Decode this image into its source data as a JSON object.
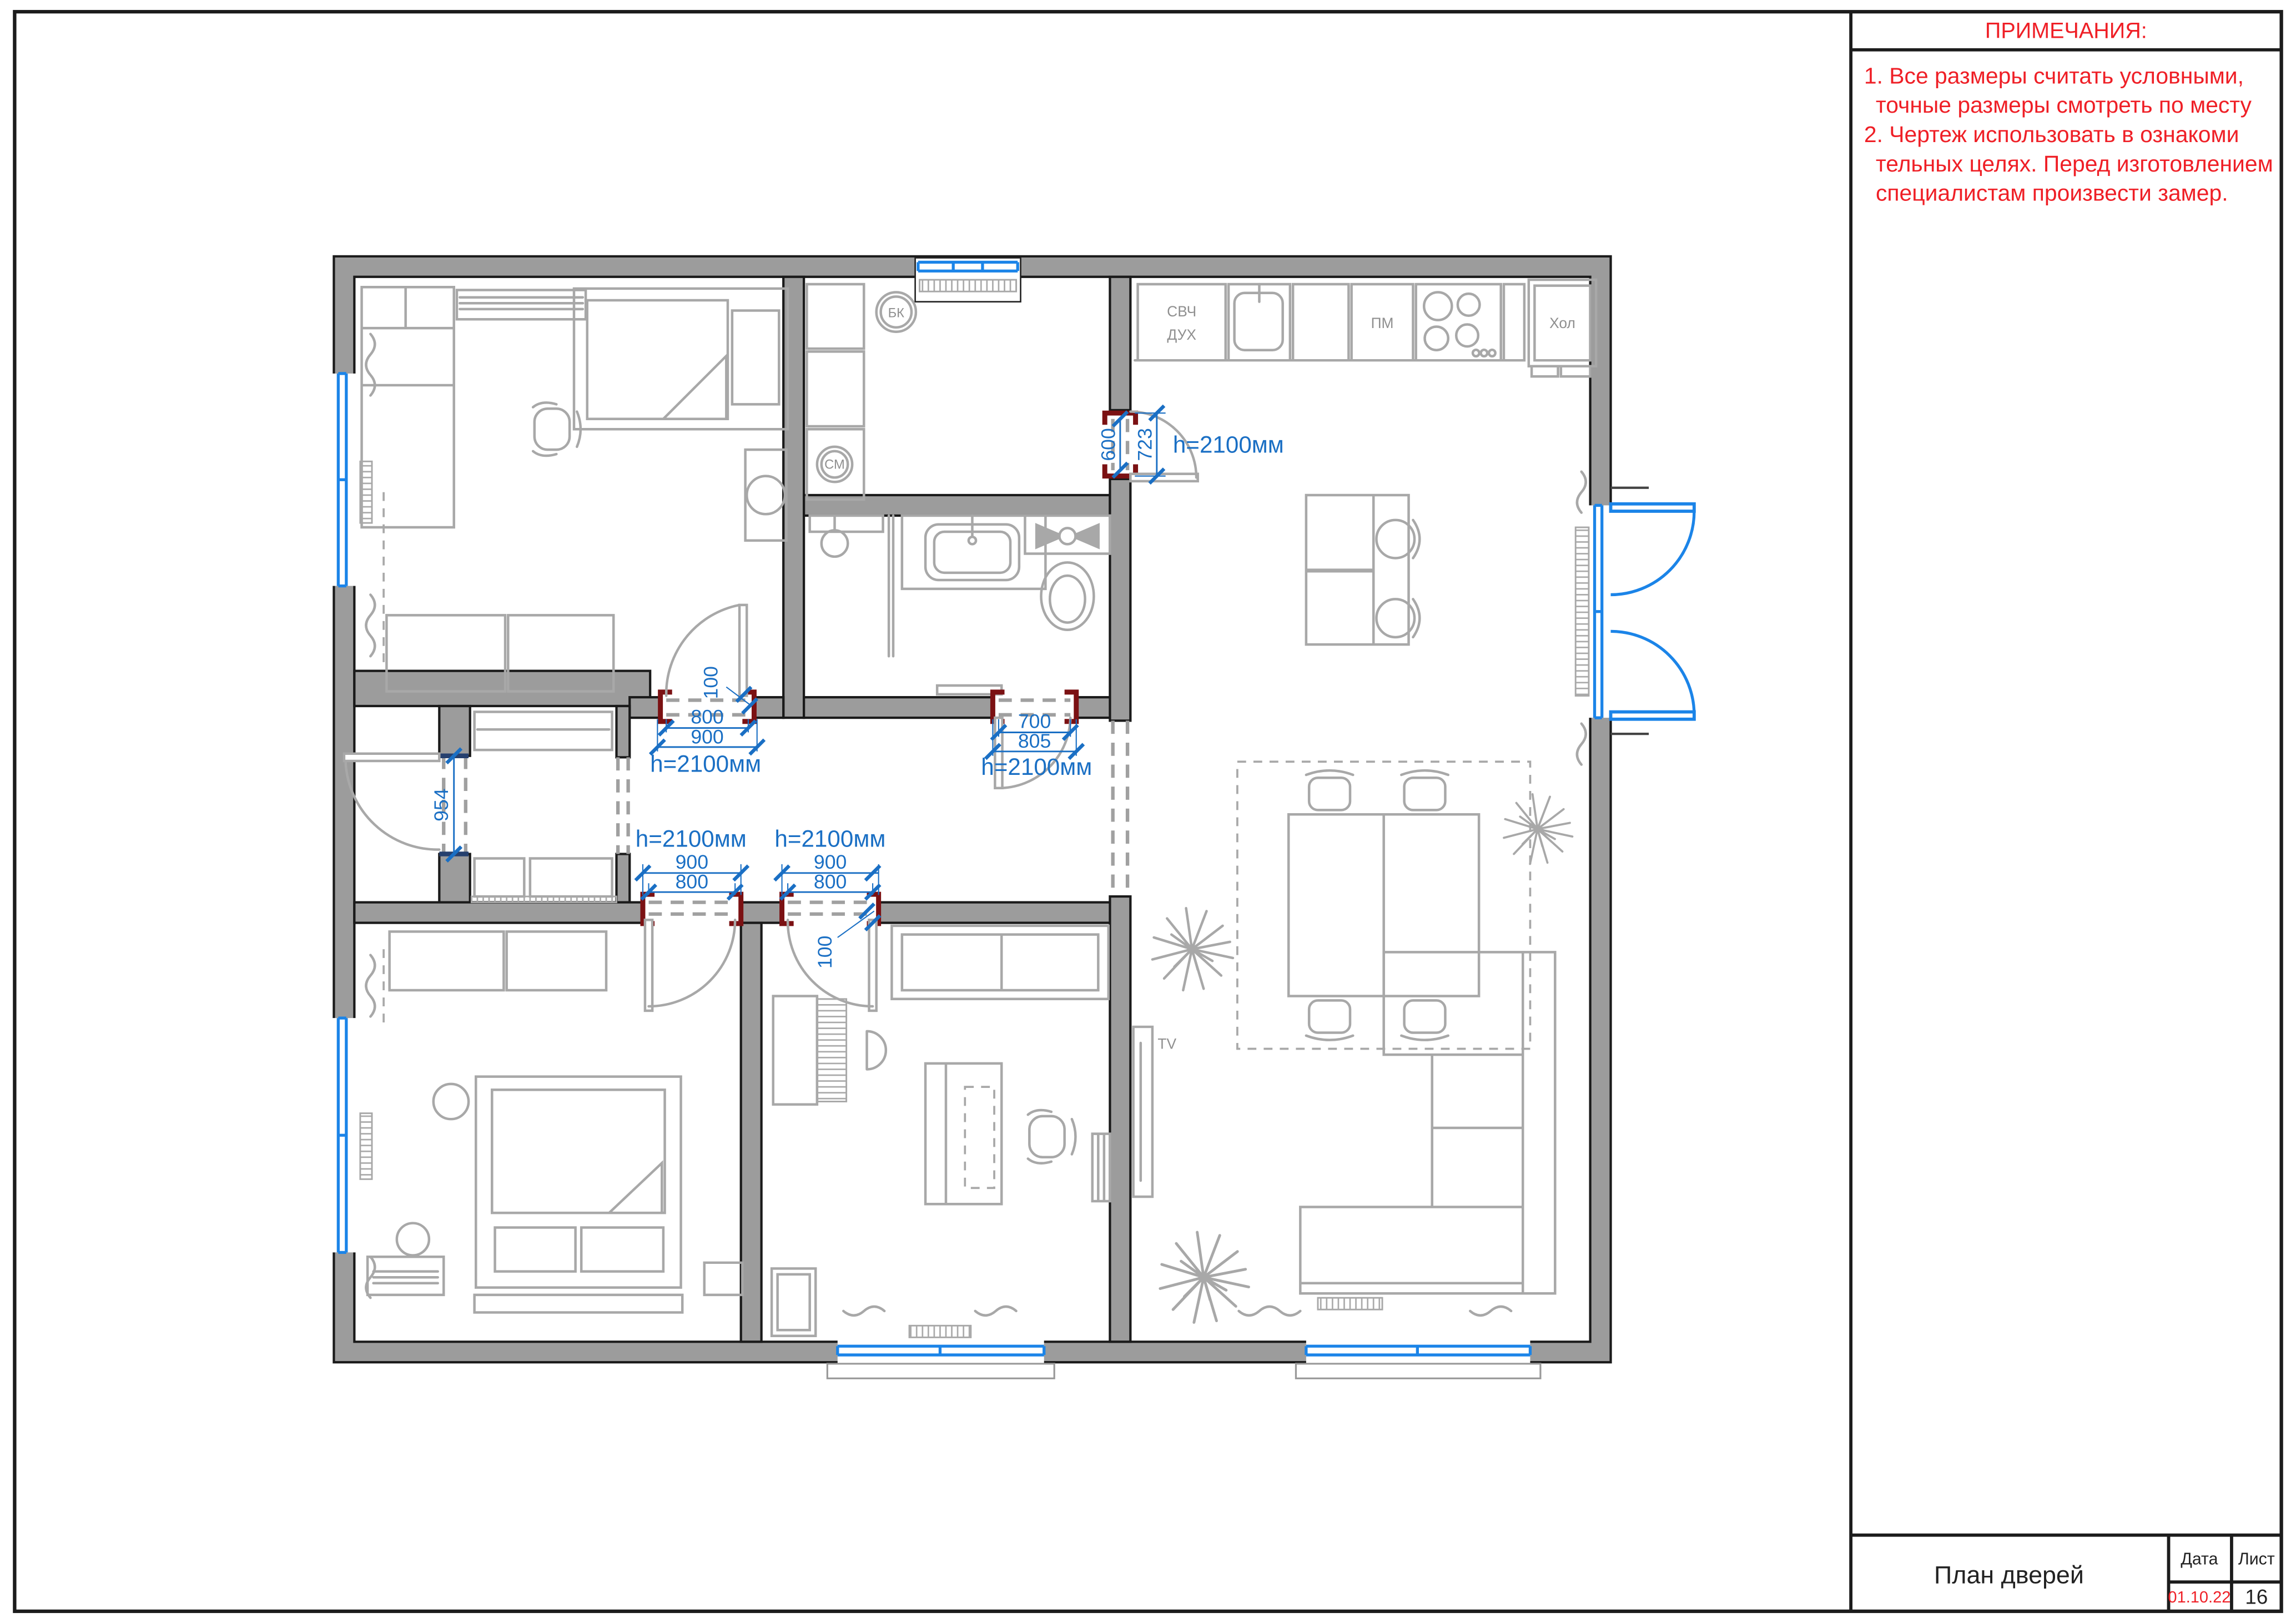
{
  "notes": {
    "header": "ПРИМЕЧАНИЯ:",
    "lines": [
      "1. Все размеры считать условными,",
      "точные размеры смотреть по месту",
      "2. Чертеж использовать в ознакоми",
      "тельных целях. Перед изготовлением",
      "специалистам произвести замер."
    ]
  },
  "title_block": {
    "title": "План дверей",
    "date_label": "Дата",
    "date_value": "01.10.22",
    "sheet_label": "Лист",
    "sheet_value": "16"
  },
  "plan": {
    "appliances": {
      "microwave": "СВЧ",
      "oven": "ДУХ",
      "dishwasher": "ПМ",
      "fridge": "Хол",
      "boiler": "БК",
      "washing_machine": "СМ",
      "tv": "TV"
    },
    "doors": {
      "room1": {
        "height": "h=2100мм",
        "clear_width": "800",
        "frame_width": "900",
        "wall_thickness": "100"
      },
      "bathroom": {
        "height": "h=2100мм",
        "clear_width": "700",
        "frame_width": "805"
      },
      "bedroom": {
        "height": "h=2100мм",
        "clear_width": "800",
        "frame_width": "900"
      },
      "office": {
        "height": "h=2100мм",
        "clear_width": "800",
        "frame_width": "900",
        "wall_thickness": "100"
      },
      "kitchen": {
        "height": "h=2100мм",
        "clear_width": "600",
        "frame_width": "723"
      },
      "closet_opening": {
        "width": "954"
      }
    }
  },
  "colors": {
    "dimension_blue": "#1a6fc4",
    "window_blue": "#1b84e8",
    "note_red": "#ef1f26",
    "door_jamb_red": "#7b1113",
    "wall_gray": "#9c9c9c",
    "furniture_gray": "#a8a8a8"
  }
}
